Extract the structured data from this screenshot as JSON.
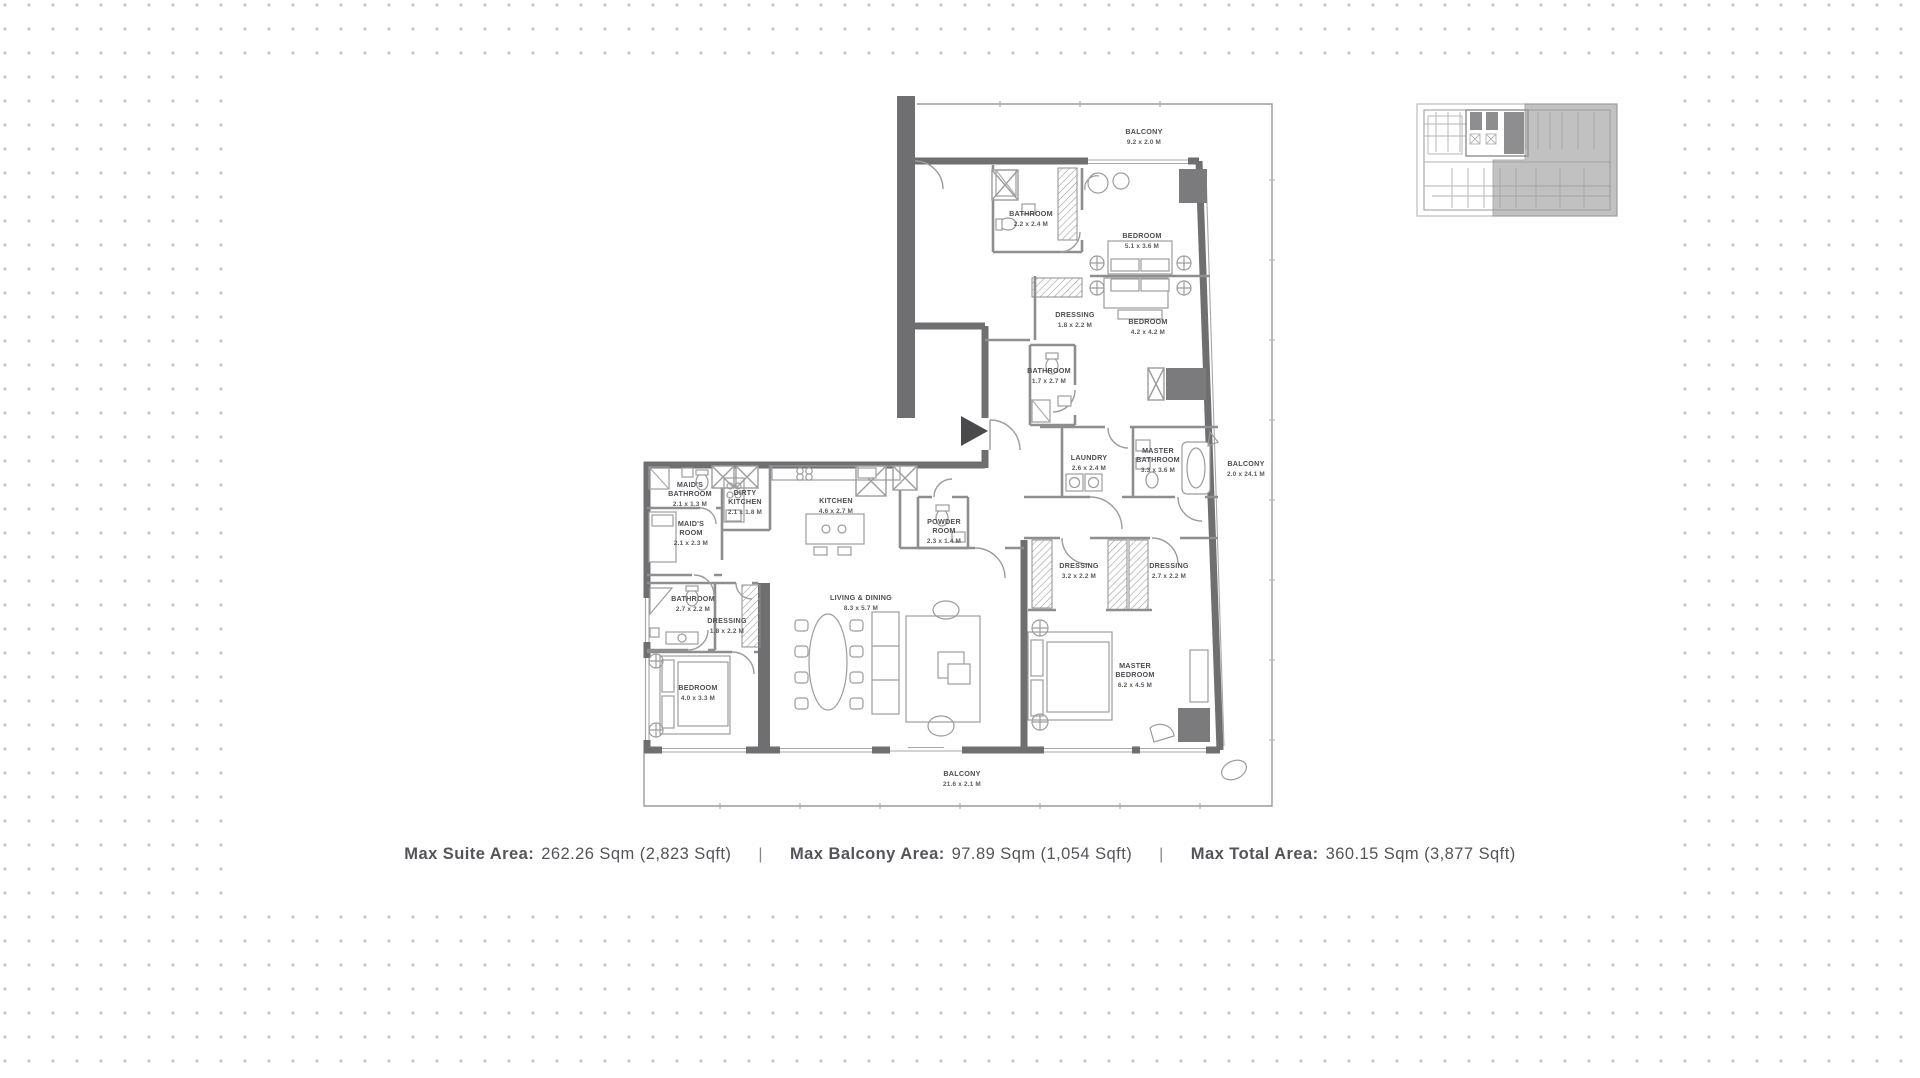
{
  "floor_plan": {
    "rooms": [
      {
        "id": "balcony-top",
        "lines": [
          "BALCONY",
          "9.2 x 2.0 M"
        ]
      },
      {
        "id": "bathroom-1",
        "lines": [
          "BATHROOM",
          "2.2 x 2.4 M"
        ]
      },
      {
        "id": "bedroom-1",
        "lines": [
          "BEDROOM",
          "5.1 x 3.6 M"
        ]
      },
      {
        "id": "dressing-1",
        "lines": [
          "DRESSING",
          "1.8 x 2.2 M"
        ]
      },
      {
        "id": "bedroom-2",
        "lines": [
          "BEDROOM",
          "4.2 x 4.2 M"
        ]
      },
      {
        "id": "bathroom-2",
        "lines": [
          "BATHROOM",
          "1.7 x 2.7 M"
        ]
      },
      {
        "id": "laundry",
        "lines": [
          "LAUNDRY",
          "2.6 x 2.4 M"
        ]
      },
      {
        "id": "master-bathroom",
        "lines": [
          "MASTER",
          "BATHROOM",
          "3.3 x 3.6 M"
        ]
      },
      {
        "id": "balcony-right",
        "lines": [
          "BALCONY",
          "2.0 x 24.1 M"
        ]
      },
      {
        "id": "dressing-2",
        "lines": [
          "DRESSING",
          "3.2 x 2.2 M"
        ]
      },
      {
        "id": "dressing-3",
        "lines": [
          "DRESSING",
          "2.7 x 2.2 M"
        ]
      },
      {
        "id": "master-bedroom",
        "lines": [
          "MASTER",
          "BEDROOM",
          "6.2 x 4.5 M"
        ]
      },
      {
        "id": "maids-bathroom",
        "lines": [
          "MAID'S",
          "BATHROOM",
          "2.1 x 1.3 M"
        ]
      },
      {
        "id": "maids-room",
        "lines": [
          "MAID'S",
          "ROOM",
          "2.1 x 2.3 M"
        ]
      },
      {
        "id": "dirty-kitchen",
        "lines": [
          "DIRTY",
          "KITCHEN",
          "2.1 x 1.8 M"
        ]
      },
      {
        "id": "kitchen",
        "lines": [
          "KITCHEN",
          "4.6 x 2.7 M"
        ]
      },
      {
        "id": "powder-room",
        "lines": [
          "POWDER",
          "ROOM",
          "2.3 x 1.4 M"
        ]
      },
      {
        "id": "bathroom-3",
        "lines": [
          "BATHROOM",
          "2.7 x 2.2 M"
        ]
      },
      {
        "id": "dressing-4",
        "lines": [
          "DRESSING",
          "1.8 x 2.2 M"
        ]
      },
      {
        "id": "bedroom-3",
        "lines": [
          "BEDROOM",
          "4.0 x 3.3 M"
        ]
      },
      {
        "id": "living-dining",
        "lines": [
          "LIVING & DINING",
          "8.3 x 5.7 M"
        ]
      },
      {
        "id": "balcony-bottom",
        "lines": [
          "BALCONY",
          "21.6 x 2.1 M"
        ]
      }
    ]
  },
  "stats": {
    "separator": "|",
    "items": [
      {
        "label": "Max Suite Area:",
        "value": "262.26 Sqm (2,823 Sqft)"
      },
      {
        "label": "Max Balcony Area:",
        "value": "97.89 Sqm (1,054 Sqft)"
      },
      {
        "label": "Max Total Area:",
        "value": "360.15 Sqm (3,877 Sqft)"
      }
    ]
  },
  "colors": {
    "wall": "#6f6f71",
    "partition": "#8e8e90",
    "accent_dark": "#7b7b7d",
    "text": "#54555a",
    "dot": "#c3c3c4",
    "keyplan_highlight": "#9c9c9e"
  }
}
